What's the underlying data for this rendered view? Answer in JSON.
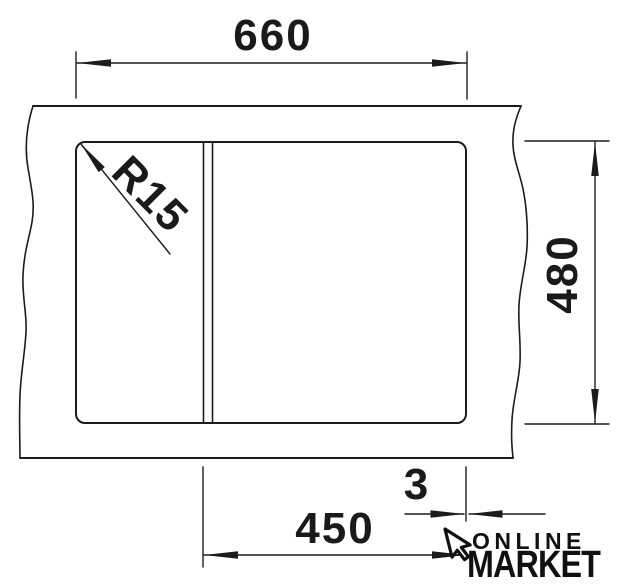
{
  "drawing": {
    "labels": {
      "top_width": "660",
      "right_height": "480",
      "bottom_width": "450",
      "edge_gap": "3",
      "corner_radius": "R15"
    },
    "watermark": {
      "line1": "ONLINE",
      "line2": "MARKET"
    },
    "colors": {
      "line": "#1c1c1c",
      "background": "#ffffff"
    }
  }
}
